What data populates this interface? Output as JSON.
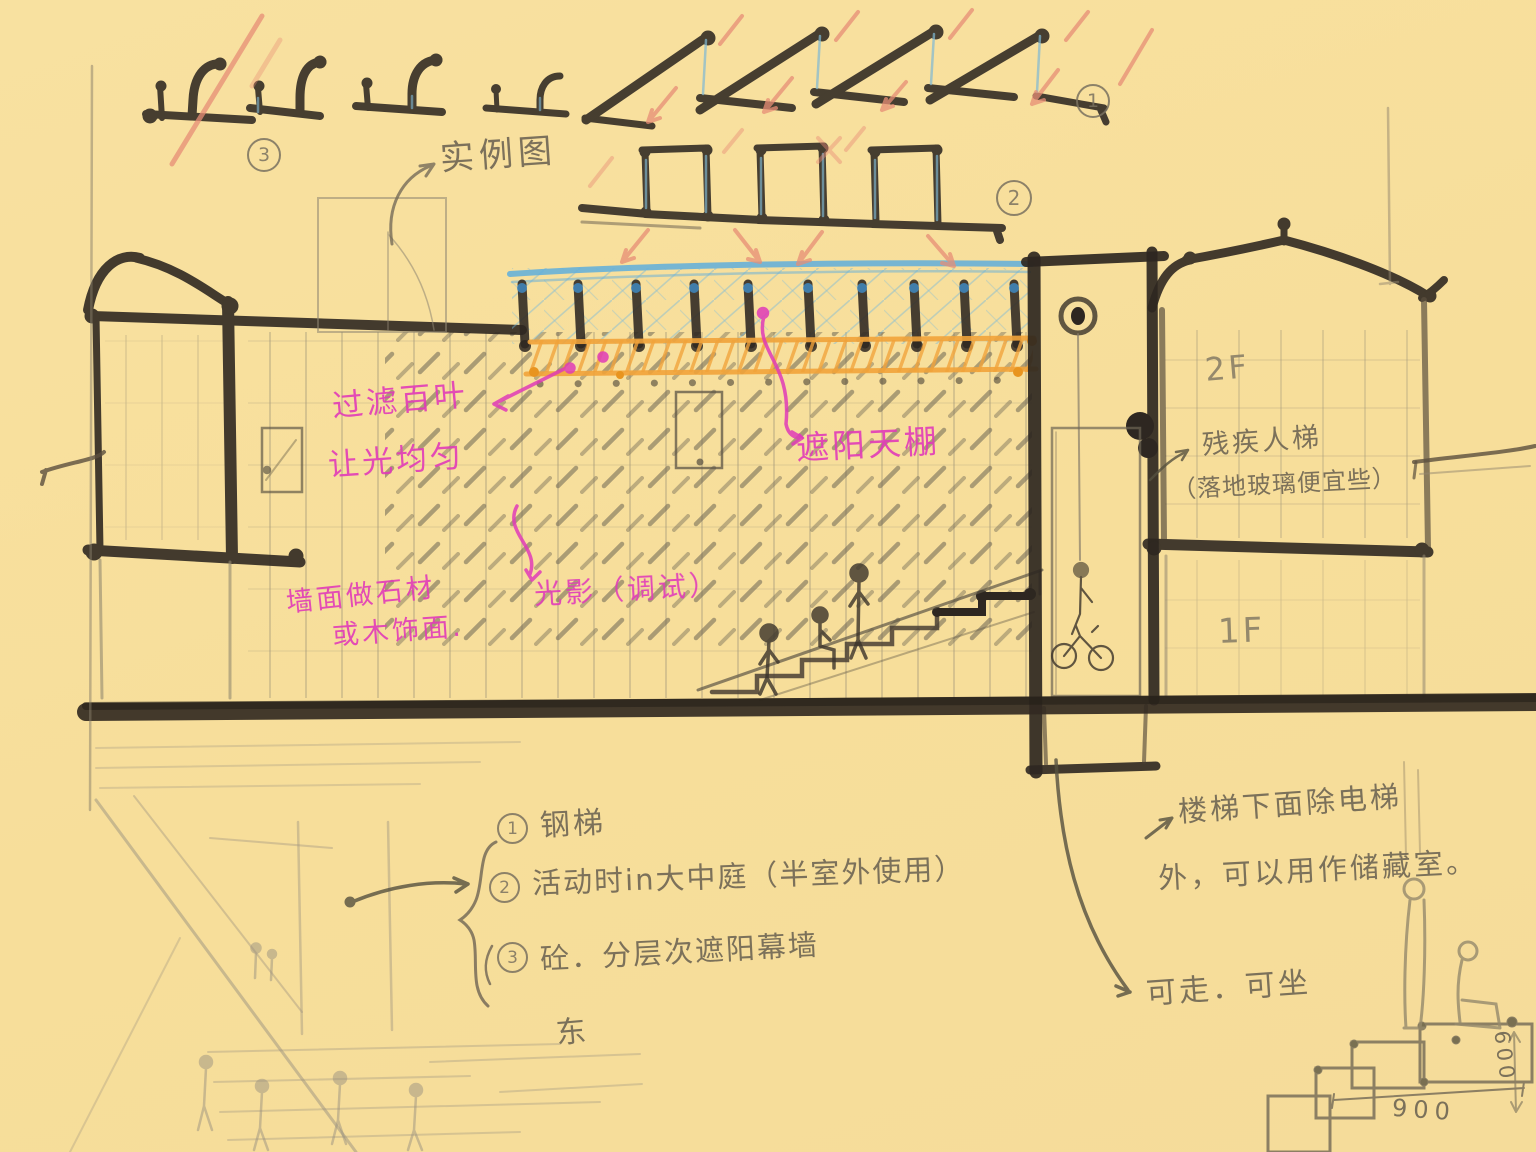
{
  "palette": {
    "paper": "#F7DE9A",
    "charcoal": "#2E2721",
    "pencil": "#877E6B",
    "pencil_faint": "#9A9180",
    "pink": "#E03BB8",
    "blue": "#66AFD9",
    "blue_dark": "#3F87C0",
    "orange": "#F1A33A",
    "salmon": "#E78E76"
  },
  "sketch": {
    "detail_markers": {
      "roof_hook_row": "3",
      "sawtooth_row": "1",
      "clerestory_row": "2"
    },
    "example_note": "实例图",
    "notes_pink": {
      "louver_line1": "过滤百叶",
      "louver_line2": "让光均匀",
      "canopy": "遮阳天棚",
      "wall_line1": "墙面做石材",
      "wall_line2": "或木饰面.",
      "light": "光影（调试）"
    },
    "notes_pencil": {
      "accessible_lift_line1": "残疾人梯",
      "accessible_lift_line2": "（落地玻璃便宜些）",
      "floor_2": "2F",
      "floor_1": "1F",
      "under_stair_line1": "楼梯下面除电梯",
      "under_stair_line2": "外，可以用作储藏室。",
      "walk_sit": "可走．可坐",
      "stray_glyph": "东",
      "dim_width": "900",
      "dim_height": "600"
    },
    "list": [
      {
        "num": "1",
        "text": "钢梯"
      },
      {
        "num": "2",
        "text": "活动时in大中庭（半室外使用）"
      },
      {
        "num": "3",
        "text": "砼．分层次遮阳幕墙"
      }
    ]
  }
}
